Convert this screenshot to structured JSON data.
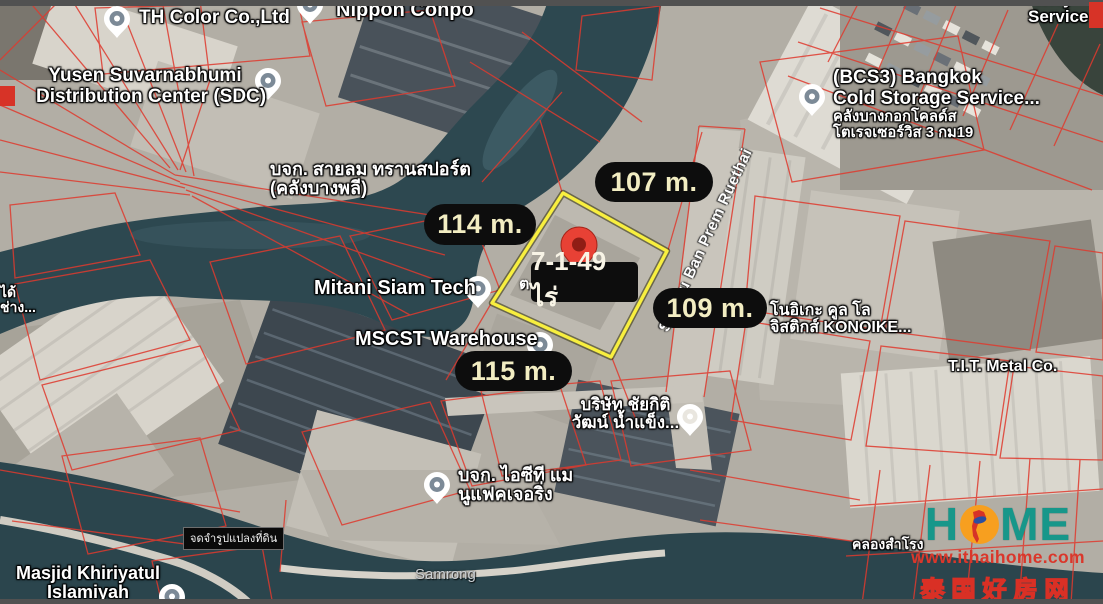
{
  "plot": {
    "area_label": "7-1-49 ไร่",
    "measurements": [
      {
        "side": "north",
        "value": "107 m."
      },
      {
        "side": "west",
        "value": "114 m."
      },
      {
        "side": "east",
        "value": "109 m."
      },
      {
        "side": "south",
        "value": "115 m."
      }
    ],
    "note_label": "จดจำรูปแปลงที่ดิน"
  },
  "map": {
    "street": "Soi Mu Ban Prem Ruethai",
    "canal": "คลองสำโรง",
    "district": "Samrong",
    "partial_glyph": "ต",
    "pois": [
      {
        "name": "th-color",
        "lines": [
          "TH Color Co.,Ltd"
        ]
      },
      {
        "name": "yusen-sdc",
        "lines": [
          "Yusen Suvarnabhumi",
          "Distribution Center (SDC)"
        ]
      },
      {
        "name": "nippon-conpo",
        "lines": [
          "Nippon Conpo"
        ]
      },
      {
        "name": "kerry-service",
        "lines": [
          "Kerry",
          "Service l"
        ]
      },
      {
        "name": "bcs3-cold-storage",
        "lines": [
          "(BCS3) Bangkok",
          "Cold Storage Service..."
        ],
        "sub": [
          "คลังบางกอกโคลด์ส",
          "โตเรจเซอร์วิส 3 กม19"
        ]
      },
      {
        "name": "sailom-transport",
        "lines": [
          "บจก. สายลม ทรานสปอร์ต",
          "(คลังบางพลี)"
        ]
      },
      {
        "name": "mitani-siam-tech",
        "lines": [
          "Mitani Siam Tech"
        ]
      },
      {
        "name": "mscst-warehouse",
        "lines": [
          "MSCST Warehouse"
        ]
      },
      {
        "name": "konoike-cool-logistics",
        "lines": [
          "โนอิเกะ คูล โล",
          "จิสติกส์ KONOIKE..."
        ]
      },
      {
        "name": "tit-metal",
        "lines": [
          "T.I.T. Metal Co."
        ]
      },
      {
        "name": "chaikiti-ice",
        "lines": [
          "บริษัท ชัยกิติ",
          "วัฒน์ น้ำแข็ง..."
        ]
      },
      {
        "name": "ict-manufacturing",
        "lines": [
          "บจก. ไอซีที แม",
          "นูแฟคเจอริ่ง"
        ]
      },
      {
        "name": "masjid-khiriyatul",
        "lines": [
          "Masjid Khiriyatul",
          "Islamiyah"
        ]
      },
      {
        "name": "left-edge-partial",
        "lines": [
          "ได้",
          "ช่าง..."
        ]
      }
    ]
  },
  "watermark": {
    "brand": "HOME",
    "brand_left": "H",
    "brand_right": "ME",
    "url": "www.ithaihome.com",
    "tagline": "泰国好房网"
  },
  "colors": {
    "plot_outline_yellow": "#f8ef3f",
    "pill_bg": "#0d0d0d",
    "pill_text": "#f2edc2",
    "area_text": "#f8f4e6",
    "main_pin_red": "#e84135",
    "parcel_line_red": "#df3a2e",
    "water_teal": "#2d4850",
    "brand_teal": "#17978a",
    "brand_orange": "#f79f1f",
    "brand_red": "#da372b"
  }
}
